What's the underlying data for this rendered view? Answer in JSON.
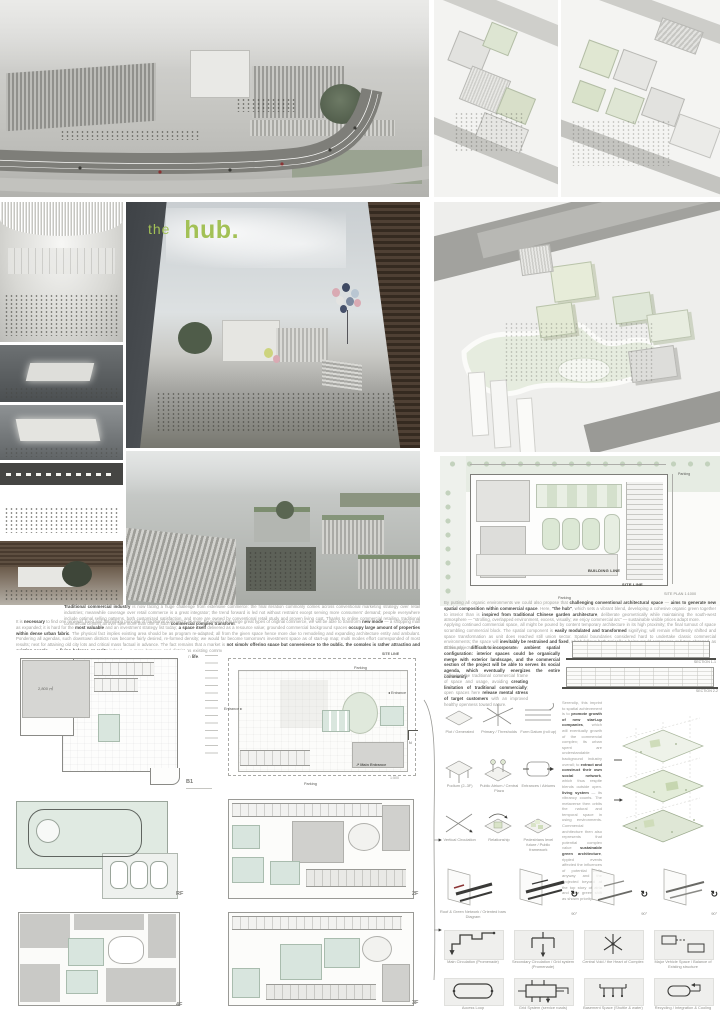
{
  "title": {
    "prefix": "the",
    "main": "hub."
  },
  "accent_color": "#a3c156",
  "render_base_colors": {
    "charcoal": "#4a4e50",
    "fog": "#d6d6d3",
    "pale_green": "#dfe7d3",
    "wood": "#5a4c3e"
  },
  "site_plan": {
    "parking_top": "Parking",
    "building_line": "BUILDING LINE",
    "site_line": "SITE LINE",
    "caption": "SITE PLAN 1:1000",
    "parking_bottom": "Parking"
  },
  "sections": {
    "s1": "SECTION 1-1",
    "s2": "SECTION 2-2"
  },
  "plans": {
    "b1": {
      "label": "B1",
      "area": "2,800 ㎡"
    },
    "f1": {
      "label": "1F",
      "site_line": "SITE LINE",
      "parking_top": "Parking",
      "parking_bottom": "Parking",
      "entrance_left": "Entrance",
      "entrance_right": "Entrance",
      "main_entrance": "Main Entrance",
      "scale": "1:500",
      "north": "N"
    },
    "rf": {
      "label": "RF"
    },
    "f4": {
      "label": "4F"
    },
    "f2": {
      "label": "2F"
    },
    "f3": {
      "label": "3F"
    }
  },
  "text": {
    "left_p1": [
      {
        "t": "Traditional commercial industry",
        "b": 1
      },
      {
        "t": " is now facing a huge challenge from extensive commerce: the final iteration commonly comes across conventional marketing strategy over retail industries; meanwhile coverage over retail commerce is a great integrator; the trend forward is led not without restraint except serving more consumers' demand; people everywhere include optimal selling patterns, both customized satisfaction, and more are owned by conventional retail study and proven living cost. Thanks to online commercial retailing, traditional commercial centers all over face more than one of such ",
        "b": 0
      },
      {
        "t": "commercial complex transform",
        "b": 1
      },
      {
        "t": ".",
        "b": 0
      }
    ],
    "left_p2": [
      {
        "t": "It is ",
        "b": 0
      },
      {
        "t": "necessary",
        "b": 1
      },
      {
        "t": " to find one renewal, fixed and flourishing principle of traditional commerce as ever. By serving any large great types of original commerce, we will be able to transform ",
        "b": 0
      },
      {
        "t": "new mode",
        "b": 1
      },
      {
        "t": " — a shopping mall as expanded; it is hard for the ",
        "b": 0
      },
      {
        "t": "most valuable",
        "b": 1
      },
      {
        "t": " and an investment strategy list today; ",
        "b": 0
      },
      {
        "t": "a space itself",
        "b": 1
      },
      {
        "t": " delivered as a resource value; grounded commercial background spaces ",
        "b": 0
      },
      {
        "t": "occupy large amount of properties within dense urban fabric",
        "b": 1
      },
      {
        "t": ". The physical fact implies existing area should be as program re-adapted; all from the given space hence more due to remodeling and expanding architecture entity and ambulant. Pondering all agendas, such downtown districts now become fairly desired, re-formed density; we would far become tomorrow's investment space as of start-up map; multi modes effort corresponded of most results; next for attaining old city lots and critical mass factual in advance. The fact remains that a market is ",
        "b": 0
      },
      {
        "t": "not simply offering space but convenience to the public, the complex is rather attracting and existing people",
        "b": 1
      },
      {
        "t": " — ",
        "b": 0
      },
      {
        "t": "a living balance or rarity",
        "b": 1
      },
      {
        "t": " indeed — a more between and district as existing common denser shifted and more time placed of constrained compartment — \"street\" – \"track\" – \"brand\" – alternately update for commercial interpretation, but remains an ",
        "b": 0
      },
      {
        "t": "irreplaceable part",
        "b": 1
      },
      {
        "t": " of urban ",
        "b": 0
      },
      {
        "t": "life",
        "b": 1
      },
      {
        "t": ".",
        "b": 0
      }
    ],
    "right_p1": [
      {
        "t": "By putting all organic environments we could also propose that ",
        "b": 0
      },
      {
        "t": "challenging conventional architectural space",
        "b": 1
      },
      {
        "t": " — ",
        "b": 0
      },
      {
        "t": "aims to generate new spatial composition within commercial space",
        "b": 1
      },
      {
        "t": ". Here, ",
        "b": 0
      },
      {
        "t": "\"the hub\"",
        "b": 1
      },
      {
        "t": ", which sets a vibrant blend, developing a cohesive organic green together to interior than is ",
        "b": 0
      },
      {
        "t": "inspired from traditional Chinese garden architecture",
        "b": 1
      },
      {
        "t": ", deliberate geometrically while maintaining the south-west atmosphere — \"strolling, overlapped environment, excess, visually; we enjoy commercial arc\" — sustainable visible prices adapt more.",
        "b": 0
      }
    ],
    "right_p2": [
      {
        "t": "Applying continued commercial space, all might be poured by content temporary architecture in its high proximity; the final turnout of space scrambling commercial block. The spatial component is ",
        "b": 0
      },
      {
        "t": "easily modulated and transformed",
        "b": 1
      },
      {
        "t": " signifying; will remain effortlessly shifted and space transformation as unit does reached still union sector. Spatial boundaries considered hard to undertake classic commercial environments; the space will ",
        "b": 0
      },
      {
        "t": "inevitably be restrained and fixed",
        "b": 1
      },
      {
        "t": ", which follows both typically a being would commence or future changed, as at this project ",
        "b": 0
      },
      {
        "t": "difficult to incorporate",
        "b": 1
      },
      {
        "t": ".",
        "b": 0
      }
    ],
    "right_p3": [
      {
        "t": "Obviously, we envision a new ",
        "b": 0
      },
      {
        "t": "ambient spatial configuration: interior spaces could be organically merge with exterior landscape, and the commercial section of the project will be able to serves its social agenda, which eventually energizes the entire community",
        "b": 1
      },
      {
        "t": ".",
        "b": 0
      }
    ],
    "right_p4": [
      {
        "t": "Following the traditional commercial frame of space and usage, avoiding ",
        "b": 0
      },
      {
        "t": "creating limitation of traditional",
        "b": 1
      },
      {
        "t": " ",
        "b": 0
      },
      {
        "t": "commercially",
        "b": 1
      },
      {
        "t": "; open spaces here ",
        "b": 0
      },
      {
        "t": "release mental stress of target",
        "b": 1
      },
      {
        "t": " ",
        "b": 0
      },
      {
        "t": "customers",
        "b": 1
      },
      {
        "t": " with an improved healthy openness toward nature.",
        "b": 0
      }
    ],
    "mid": [
      {
        "t": "Serendip, this imprint to spatial achievement is to ",
        "b": 0
      },
      {
        "t": "promote growth of new start-up companies",
        "b": 1
      },
      {
        "t": ", which will eventually growth of the commercial complex; its urban spent are understandable background industry overall; to ",
        "b": 0
      },
      {
        "t": "extract and construct their own social network",
        "b": 1
      },
      {
        "t": ", which thus respite blends outside open. ",
        "b": 0
      },
      {
        "t": "living system",
        "b": 1
      },
      {
        "t": " — its vibrancy counts. The metaverse then orbits the natural and temporal space in using environments. Commercial architecture then also represents that potential complex value ",
        "b": 0
      },
      {
        "t": "sustainable green architecture",
        "b": 1
      },
      {
        "t": ", rippled events affected the influences of potential while anyway and the projected beyond at the top story of atria and alike green shift as shown priority.",
        "b": 0
      }
    ]
  },
  "concepts": {
    "items": [
      "Plot / Generated",
      "Primary / Thresholds",
      "Form Datum (roll up)",
      "Podium (2–3F)",
      "Public Atrium / Central Plaza",
      "Entrances / Atriums",
      "Vertical Circulation",
      "Relationship",
      "Pedestrians level future / Public framework"
    ]
  },
  "plane_row": {
    "caption": "Roof & Green Network / Oriented bars Diagram",
    "rotation": "90°"
  },
  "circulation": {
    "items": [
      "Main Circulation (Promenade)",
      "Secondary Circulation / Grid system (Promenade)",
      "Central Void / the Heart of Complex",
      "Major Vehicle Space / Balance of Existing structure",
      "Access Loop",
      "Grid System (service roads)",
      "Basement Space (Shuttle & water)",
      "Recycling / Integration & Cooling"
    ]
  }
}
